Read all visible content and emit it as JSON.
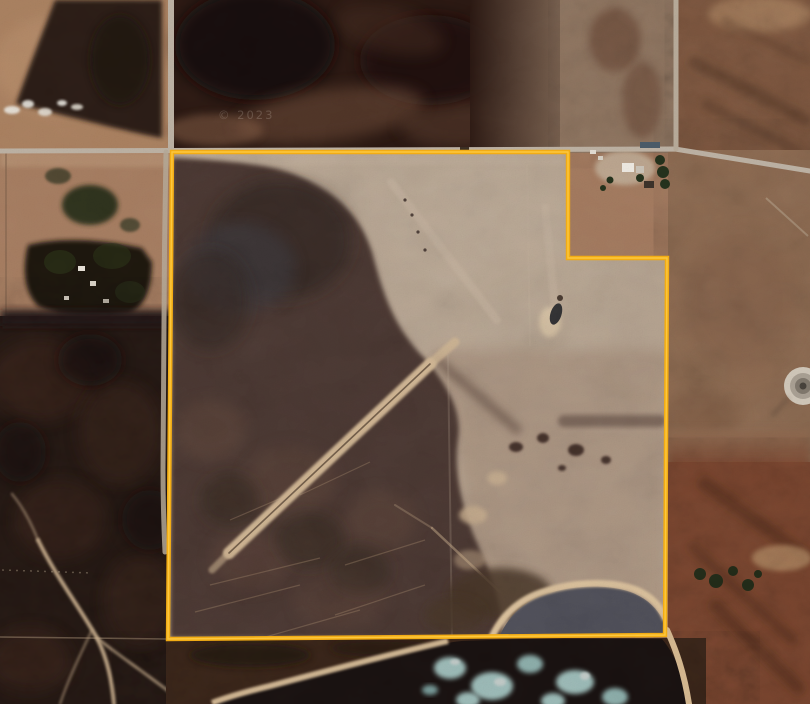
{
  "window": {
    "width_px": 810,
    "height_px": 704,
    "kind": "satellite aerial imagery with parcel overlay"
  },
  "map": {
    "type": "satellite",
    "watermark_text": "© 2023",
    "parcel_overlay": {
      "boundary_color": "#F2AC14",
      "boundary_highlight": "#FFD24F",
      "shape": "square quarter-section parcel with rectangular notch excluded at the north-east corner",
      "points": "172,152 568,152 568,258 667,258 665,635 168,639"
    },
    "features": [
      {
        "name": "north-road",
        "desc": "east-west gravel road along top of parcel"
      },
      {
        "name": "west-road",
        "desc": "north-south road along west boundary"
      },
      {
        "name": "east-road",
        "desc": "north-south road at top right"
      },
      {
        "name": "farmstead-northeast",
        "desc": "yard with buildings inside excluded notch"
      },
      {
        "name": "farmstead-west",
        "desc": "treed yard west of parcel"
      },
      {
        "name": "interior-forest",
        "desc": "dark regenerating forest across west/centre of parcel"
      },
      {
        "name": "cleared-airstrip",
        "desc": "light cleared area with faint diagonal strips, NE interior"
      },
      {
        "name": "sand-runway",
        "desc": "bright sandy diagonal cutline through forest"
      },
      {
        "name": "small-pond",
        "desc": "small dark pond with sand rim, centre-east"
      },
      {
        "name": "round-dugout",
        "desc": "circular dugout at right edge"
      },
      {
        "name": "beach",
        "desc": "sandy shoreline curve at south-east corner"
      },
      {
        "name": "lake",
        "desc": "dark lake with cyan ice patches at bottom"
      },
      {
        "name": "forest-southwest",
        "desc": "dense dark bush south-west of parcel with sandy trails"
      },
      {
        "name": "shrubland-east",
        "desc": "reddish-brown shrubland east and south-east"
      }
    ],
    "palette": {
      "field_tan": "#A9805F",
      "cleared_gray": "#B9A794",
      "dark_field": "#2A1812",
      "interior_forest": "#4C3730",
      "black_forest": "#241813",
      "shrub_red": "#7A452E",
      "water_slate": "#50505A",
      "water_dark": "#181110",
      "ice_cyan": "#BCE4E0",
      "sand": "#D9BE99",
      "road": "#BCB1A3"
    }
  }
}
